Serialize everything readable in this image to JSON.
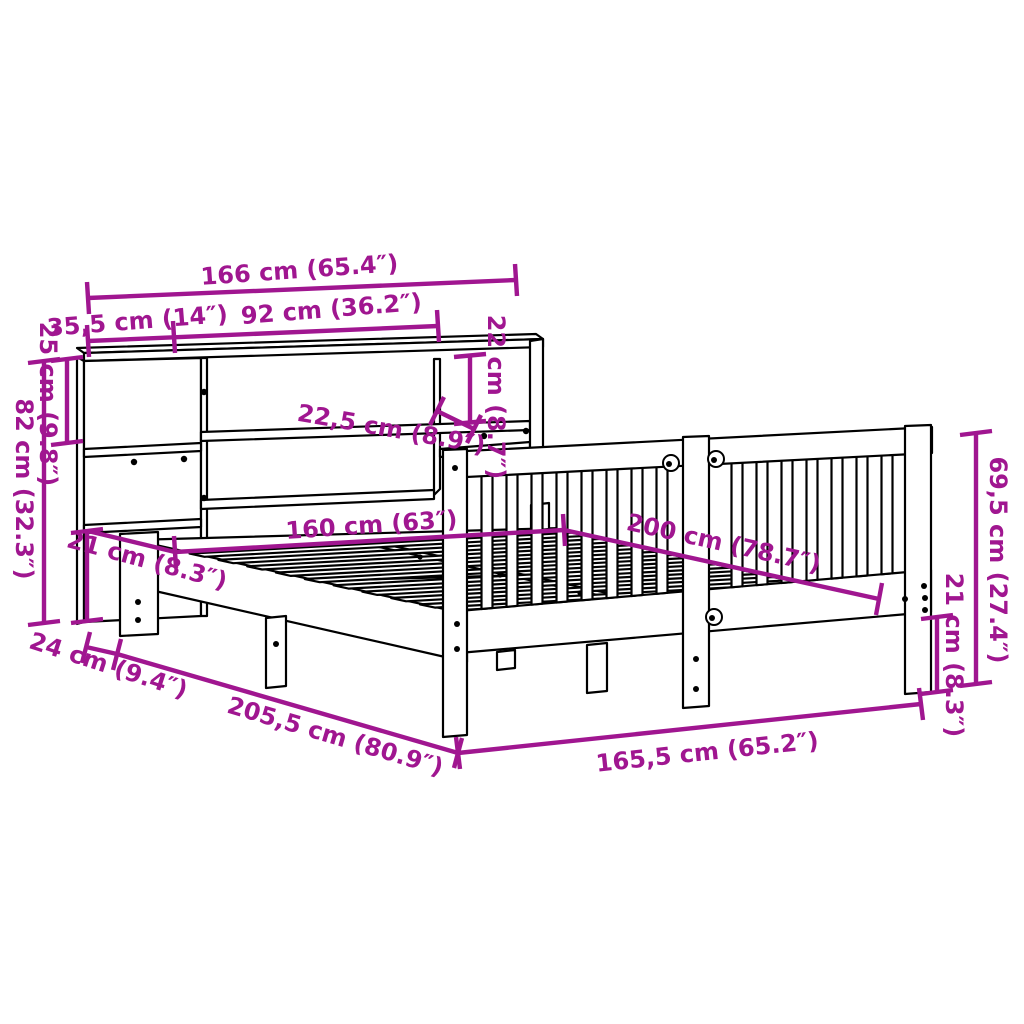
{
  "diagram": {
    "title": "Bed frame with bookcase headboard — dimension diagram",
    "colors": {
      "dimension": "#A01690",
      "line": "#000000",
      "background": "#FFFFFF"
    },
    "dimensions": {
      "total_width": "166 cm (65.4″)",
      "bookcase_side_width": "35,5 cm (14″)",
      "shelf_opening_width": "92 cm (36.2″)",
      "top_shelf_height": "22 cm (8.7″)",
      "shelf_depth": "22,5 cm (8.9″)",
      "top_section_height": "25 cm (9.8″)",
      "bookcase_height": "82 cm (32.3″)",
      "lower_opening_height": "21 cm (8.3″)",
      "bookcase_depth": "24 cm (9.4″)",
      "total_length": "205,5 cm (80.9″)",
      "bed_width": "160 cm (63″)",
      "bed_length": "200 cm (78.7″)",
      "frame_width": "165,5 cm (65.2″)",
      "headboard_height": "69,5 cm (27.4″)",
      "frame_height": "21 cm (8.3″)"
    }
  }
}
